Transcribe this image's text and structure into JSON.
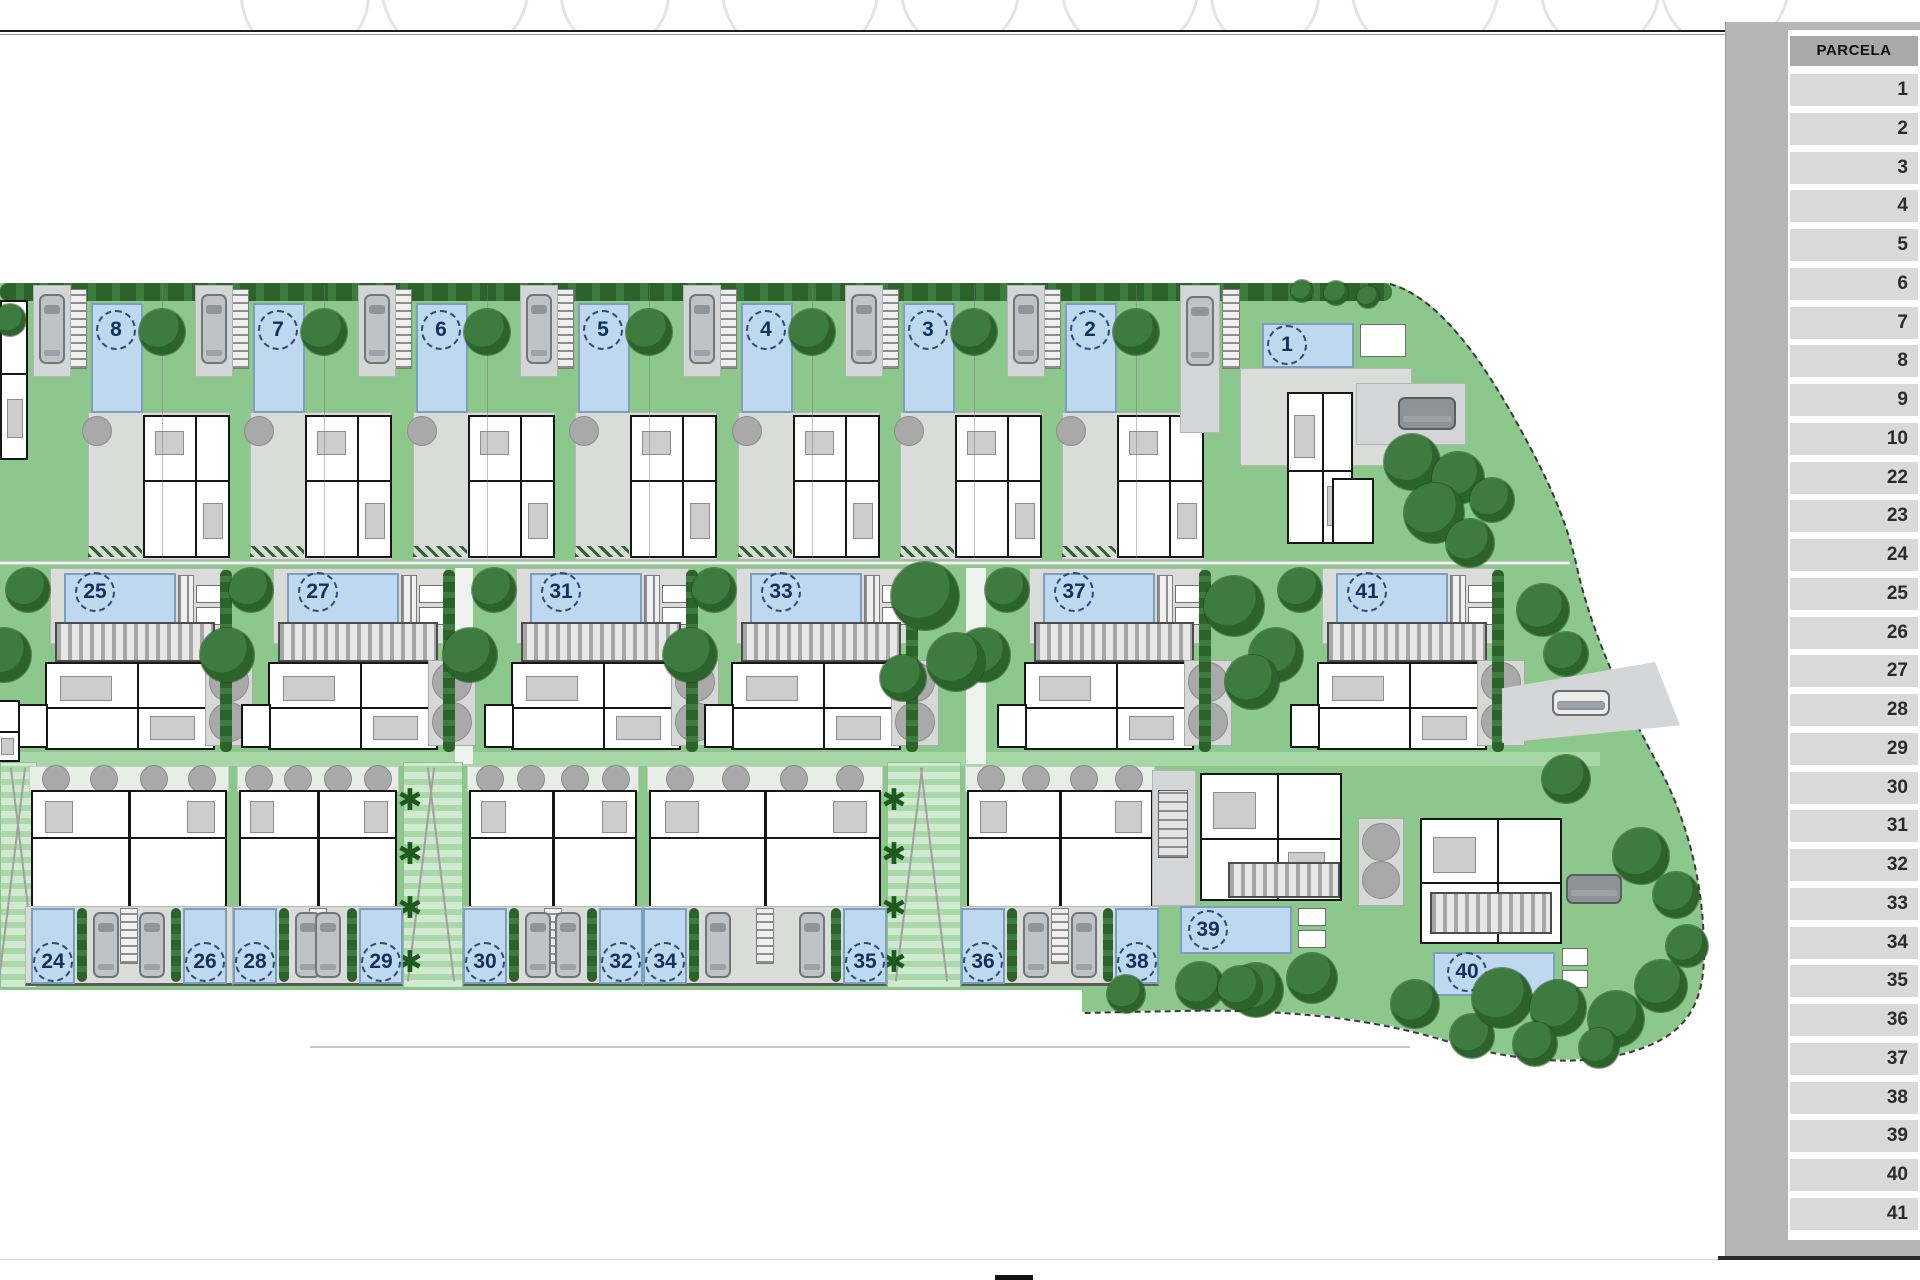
{
  "parcela_table": {
    "header": "PARCELA",
    "rows": [
      "1",
      "2",
      "3",
      "4",
      "5",
      "6",
      "7",
      "8",
      "9",
      "10",
      "22",
      "23",
      "24",
      "25",
      "26",
      "27",
      "28",
      "29",
      "30",
      "31",
      "32",
      "33",
      "34",
      "35",
      "36",
      "37",
      "38",
      "39",
      "40",
      "41"
    ]
  },
  "plan": {
    "colors": {
      "grass": "#8cc78c",
      "tree_dark": "#2b632b",
      "tree_gray": "#a9a9a9",
      "pool_blue": "#bed8ef",
      "pool_border": "#7d9ebc",
      "wall_black": "#161616",
      "deck_gray": "#dadcda",
      "panel_gray": "#b6b6b6",
      "cell_gray": "#d9d9d9",
      "header_gray": "#a9a9a9",
      "number_navy": "#14305c"
    },
    "icons": {
      "palm": "✱"
    },
    "top_units": [
      {
        "n": "8",
        "x": 0
      },
      {
        "n": "7",
        "x": 162
      },
      {
        "n": "6",
        "x": 325
      },
      {
        "n": "5",
        "x": 487
      },
      {
        "n": "4",
        "x": 650
      },
      {
        "n": "3",
        "x": 812
      },
      {
        "n": "2",
        "x": 974
      }
    ],
    "unit1": {
      "n": "1",
      "drive": [
        1180,
        285,
        40,
        148
      ],
      "car": [
        1186,
        296,
        28,
        70
      ],
      "stair": [
        1222,
        289,
        18,
        80
      ],
      "deck": [
        1240,
        368,
        172,
        98
      ],
      "pool": [
        1262,
        323,
        92,
        45
      ],
      "circle": [
        1287,
        345
      ],
      "kitchen": [
        1360,
        324,
        46,
        33
      ],
      "house": [
        1287,
        392,
        66,
        152
      ],
      "wing": [
        1332,
        478,
        42,
        66
      ],
      "drive2": [
        1356,
        383,
        110,
        62
      ],
      "car2": [
        1398,
        397,
        58,
        33
      ],
      "trees": [
        [
          1412,
          462,
          28
        ],
        [
          1458,
          478,
          26
        ],
        [
          1434,
          513,
          30
        ],
        [
          1470,
          543,
          24
        ],
        [
          1492,
          500,
          22
        ]
      ],
      "hedge_trees": [
        [
          1302,
          291,
          11
        ],
        [
          1336,
          293,
          12
        ],
        [
          1368,
          297,
          11
        ]
      ]
    },
    "middle_units": [
      {
        "n": "25",
        "x": 0
      },
      {
        "n": "27",
        "x": 223
      },
      {
        "n": "31",
        "x": 466
      },
      {
        "n": "33",
        "x": 686
      },
      {
        "n": "37",
        "x": 979
      },
      {
        "n": "41",
        "x": 1272
      }
    ],
    "duplexes": [
      {
        "x1": 25,
        "x2": 233,
        "pools": [
          {
            "n": "24",
            "cx": 53
          },
          {
            "n": "26",
            "cx": 205
          }
        ]
      },
      {
        "x1": 233,
        "x2": 403,
        "pools": [
          {
            "n": "28",
            "cx": 255
          },
          {
            "n": "29",
            "cx": 381
          }
        ]
      },
      {
        "x1": 463,
        "x2": 643,
        "pools": [
          {
            "n": "30",
            "cx": 485
          },
          {
            "n": "32",
            "cx": 621
          }
        ]
      },
      {
        "x1": 643,
        "x2": 887,
        "pools": [
          {
            "n": "34",
            "cx": 665
          },
          {
            "n": "35",
            "cx": 865
          }
        ]
      },
      {
        "x1": 961,
        "x2": 1159,
        "pools": [
          {
            "n": "36",
            "cx": 983
          },
          {
            "n": "38",
            "cx": 1137
          }
        ]
      }
    ],
    "lawns": [
      {
        "x": 0,
        "w": 37,
        "palms": false
      },
      {
        "x": 403,
        "w": 60,
        "palms": true
      },
      {
        "x": 887,
        "w": 74,
        "palms": true
      }
    ],
    "paths": [
      [
        455,
        568,
        18,
        196
      ],
      [
        966,
        568,
        20,
        196
      ]
    ],
    "unit39": {
      "n": "39",
      "drive": [
        1152,
        770,
        44,
        136
      ],
      "stairobj": [
        1158,
        790,
        30,
        68
      ],
      "house": [
        1200,
        773,
        142,
        128
      ],
      "pergola": [
        1228,
        862,
        112,
        36
      ],
      "pool": [
        1180,
        906,
        112,
        48
      ],
      "circle": [
        1208,
        930
      ],
      "kitchen": [
        1298,
        908,
        28,
        18
      ],
      "kitchen2": [
        1298,
        930,
        28,
        18
      ],
      "trees": [
        [
          1200,
          986,
          24
        ],
        [
          1256,
          990,
          27
        ],
        [
          1312,
          978,
          25
        ]
      ]
    },
    "unit40": {
      "n": "40",
      "court": [
        1358,
        818,
        46,
        88
      ],
      "gtrees": [
        [
          1381,
          842,
          19
        ],
        [
          1381,
          880,
          19
        ]
      ],
      "house": [
        1420,
        818,
        142,
        126
      ],
      "pergola": [
        1430,
        892,
        122,
        42
      ],
      "pool": [
        1433,
        952,
        122,
        44
      ],
      "circle": [
        1467,
        972
      ],
      "kitchen": [
        1562,
        948,
        26,
        18
      ],
      "kitchen2": [
        1562,
        970,
        26,
        18
      ],
      "car2": [
        1566,
        874,
        56,
        30
      ],
      "trees": [
        [
          1415,
          1004,
          24
        ],
        [
          1472,
          1036,
          22
        ]
      ]
    },
    "road_wedge": {
      "rect": [
        1502,
        662,
        178,
        88
      ],
      "car": [
        50,
        28,
        58,
        26
      ]
    },
    "extra_trees": [
      [
        10,
        320,
        16
      ],
      [
        925,
        596,
        34
      ],
      [
        956,
        662,
        29
      ],
      [
        903,
        678,
        23
      ],
      [
        1234,
        606,
        30
      ],
      [
        1252,
        682,
        27
      ],
      [
        1543,
        610,
        26
      ],
      [
        1566,
        654,
        22
      ],
      [
        1566,
        779,
        24
      ],
      [
        1641,
        856,
        28
      ],
      [
        1676,
        895,
        23
      ]
    ],
    "wedge_trees": [
      [
        1502,
        998,
        30
      ],
      [
        1558,
        1008,
        28
      ],
      [
        1616,
        1019,
        28
      ],
      [
        1661,
        986,
        26
      ],
      [
        1599,
        1048,
        20
      ],
      [
        1535,
        1044,
        22
      ],
      [
        1687,
        946,
        21
      ],
      [
        1240,
        988,
        22
      ],
      [
        1126,
        994,
        19
      ]
    ]
  }
}
